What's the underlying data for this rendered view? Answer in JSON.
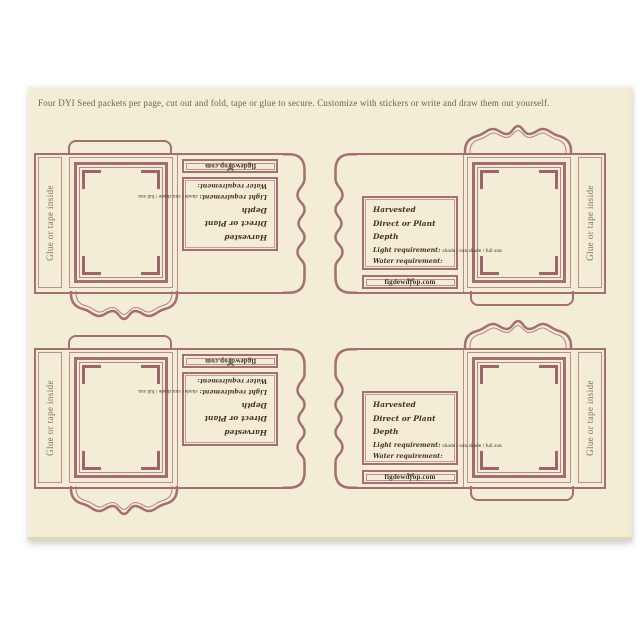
{
  "colors": {
    "pad_paper": "#f4edd5",
    "template_line_rose": "#a56f72",
    "template_line_thin": "#bb8d8f",
    "script_ink": "#43301f",
    "muted_text": "#6e6149",
    "leaf_green": "#5d6e3c"
  },
  "header": {
    "instructions": "Four DYI Seed packets per page, cut out and fold, tape or glue to secure. Customize with stickers or write and draw them out yourself."
  },
  "packet": {
    "glue_flap_label": "Glue or tape inside",
    "brand": "figdewdrop.com",
    "fields": {
      "harvested": "Harvested",
      "direct_or_plant": "Direct or Plant",
      "depth": "Depth",
      "light_requirement": "Light requirement:",
      "light_options": "shade / sun shade / full sun",
      "water_requirement": "Water requirement:"
    }
  }
}
